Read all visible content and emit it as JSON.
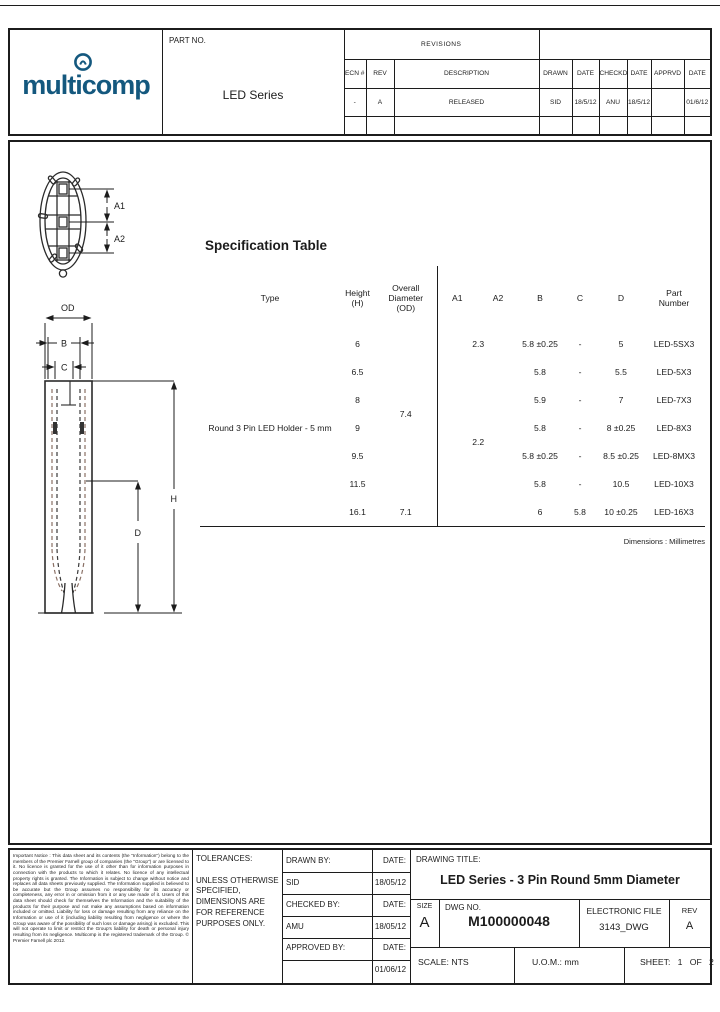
{
  "sheet": {
    "line_color": "#1c1c1c"
  },
  "header": {
    "logo": {
      "text": "multicomp",
      "color": "#14587e"
    },
    "part_no_label": "PART NO.",
    "part_no_value": "LED Series",
    "revisions": {
      "title": "REVISIONS",
      "columns": [
        "ECN #",
        "REV",
        "DESCRIPTION",
        "DRAWN",
        "DATE",
        "CHECKD",
        "DATE",
        "APPRVD",
        "DATE"
      ],
      "row": [
        "-",
        "A",
        "RELEASED",
        "SID",
        "18/5/12",
        "ANU",
        "18/5/12",
        "",
        "01/6/12"
      ]
    }
  },
  "drawing_labels": {
    "top_view": {
      "a1": "A1",
      "a2": "A2"
    },
    "side_view": {
      "od": "OD",
      "b": "B",
      "c": "C",
      "d": "D",
      "h": "H"
    }
  },
  "spec": {
    "title": "Specification Table",
    "headers": {
      "type": "Type",
      "height": "Height\n(H)",
      "od": "Overall\nDiameter\n(OD)",
      "a1": "A1",
      "a2": "A2",
      "b": "B",
      "c": "C",
      "d": "D",
      "part": "Part\nNumber"
    },
    "type_value": "Round 3 Pin LED Holder - 5 mm",
    "od_main": "7.4",
    "a_first": "2.3",
    "a_rest": "2.2",
    "rows": [
      {
        "h": "6",
        "b": "5.8 ±0.25",
        "c": "-",
        "d": "5",
        "part": "LED-5SX3"
      },
      {
        "h": "6.5",
        "b": "5.8",
        "c": "-",
        "d": "5.5",
        "part": "LED-5X3"
      },
      {
        "h": "8",
        "b": "5.9",
        "c": "-",
        "d": "7",
        "part": "LED-7X3"
      },
      {
        "h": "9",
        "b": "5.8",
        "c": "-",
        "d": "8 ±0.25",
        "part": "LED-8X3"
      },
      {
        "h": "9.5",
        "b": "5.8 ±0.25",
        "c": "-",
        "d": "8.5 ±0.25",
        "part": "LED-8MX3"
      },
      {
        "h": "11.5",
        "b": "5.8",
        "c": "-",
        "d": "10.5",
        "part": "LED-10X3"
      },
      {
        "h": "16.1",
        "od": "7.1",
        "b": "6",
        "c": "5.8",
        "d": "10 ±0.25",
        "part": "LED-16X3"
      }
    ],
    "dimensions_note": "Dimensions : Millimetres"
  },
  "title_block": {
    "tolerances": "TOLERANCES:\n\nUNLESS OTHERWISE\nSPECIFIED,\nDIMENSIONS ARE\nFOR REFERENCE\nPURPOSES ONLY.",
    "drawn_by_label": "DRAWN BY:",
    "drawn_by": "SID",
    "drawn_date_label": "DATE:",
    "drawn_date": "18/05/12",
    "checked_by_label": "CHECKED BY:",
    "checked_by": "AMU",
    "checked_date_label": "DATE:",
    "checked_date": "18/05/12",
    "approved_by_label": "APPROVED BY:",
    "approved_by": "",
    "approved_date_label": "DATE:",
    "approved_date": "01/06/12",
    "drawing_title_label": "DRAWING TITLE:",
    "drawing_title": "LED Series - 3 Pin Round 5mm Diameter",
    "size_label": "SIZE",
    "size": "A",
    "dwg_no_label": "DWG NO.",
    "dwg_no": "M100000048",
    "electronic_file_label": "ELECTRONIC FILE",
    "electronic_file": "3143_DWG",
    "rev_label": "REV",
    "rev": "A",
    "scale": "SCALE: NTS",
    "uom": "U.O.M.: mm",
    "sheet": "SHEET:   1   OF   2"
  },
  "disclaimer": "Important Notice : This data sheet and its contents (the \"Information\") belong to the members of the Premier Farnell group of companies (the \"Group\") or are licensed to it. No licence is granted for the use of it other than for information purposes in connection with the products to which it relates. No licence of any intellectual property rights is granted. The Information is subject to change without notice and replaces all data sheets previously supplied. The Information supplied is believed to be accurate but the Group assumes no responsibility for its accuracy or completeness, any error in or omission from it or any use made of it. Users of this data sheet should check for themselves the Information and the suitability of the products for their purpose and not make any assumptions based on information included or omitted. Liability for loss or damage resulting from any reliance on the Information or use of it (including liability resulting from negligence or where the Group was aware of the possibility of such loss or damage arising) is excluded. This will not operate to limit or restrict the Group's liability for death or personal injury resulting from its negligence. Multicomp is the registered trademark of the Group. © Premier Farnell plc 2012."
}
